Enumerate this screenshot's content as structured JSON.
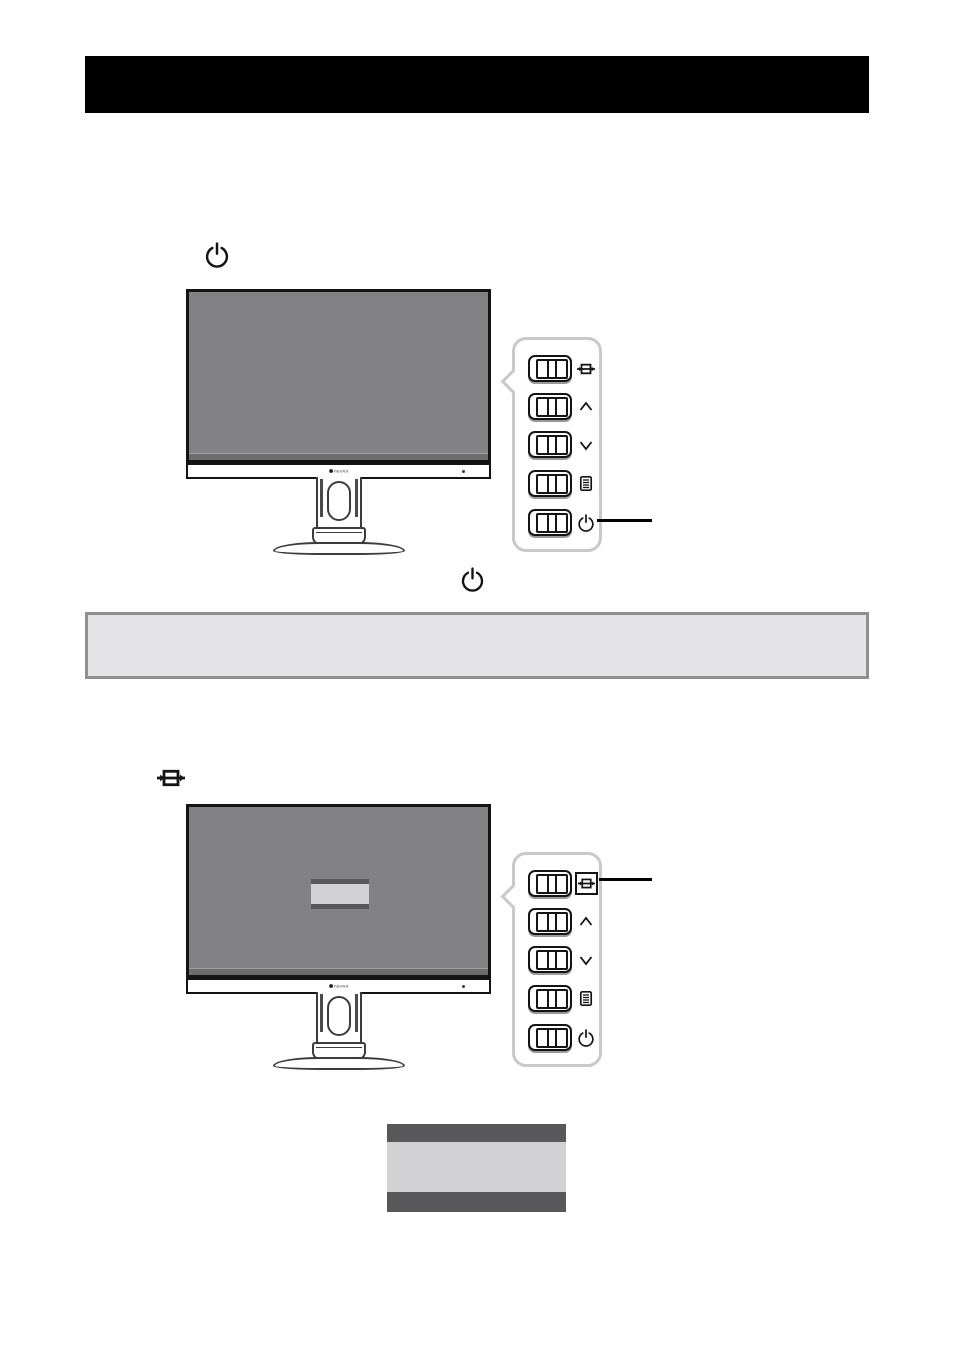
{
  "header": {
    "title": ""
  },
  "notice": {
    "text": ""
  },
  "monitor": {
    "brand": "neovo"
  },
  "figures": {
    "power_section": {
      "inline_icon": "power-icon",
      "callout_target": "power-button",
      "footer_icon": "power-icon"
    },
    "source_section": {
      "inline_icon": "source-icon",
      "callout_target": "source-button",
      "screen_overlay": "osd-menu"
    }
  },
  "control_panel": {
    "buttons": [
      {
        "id": "source",
        "icon": "source-icon"
      },
      {
        "id": "up",
        "icon": "chevron-up-icon"
      },
      {
        "id": "down",
        "icon": "chevron-down-icon"
      },
      {
        "id": "menu",
        "icon": "menu-icon"
      },
      {
        "id": "power",
        "icon": "power-icon"
      }
    ]
  },
  "osd_graphic": {
    "style": "three-bar",
    "bars": [
      "dark",
      "light",
      "dark"
    ]
  },
  "colors": {
    "header_bg": "#000000",
    "screen_gray": "#828284",
    "osd_dark": "#58585a",
    "osd_light": "#d2d2d4",
    "notice_bg": "#e4e4e6",
    "notice_border": "#8f8f8f",
    "panel_border": "#c9c9c9"
  }
}
